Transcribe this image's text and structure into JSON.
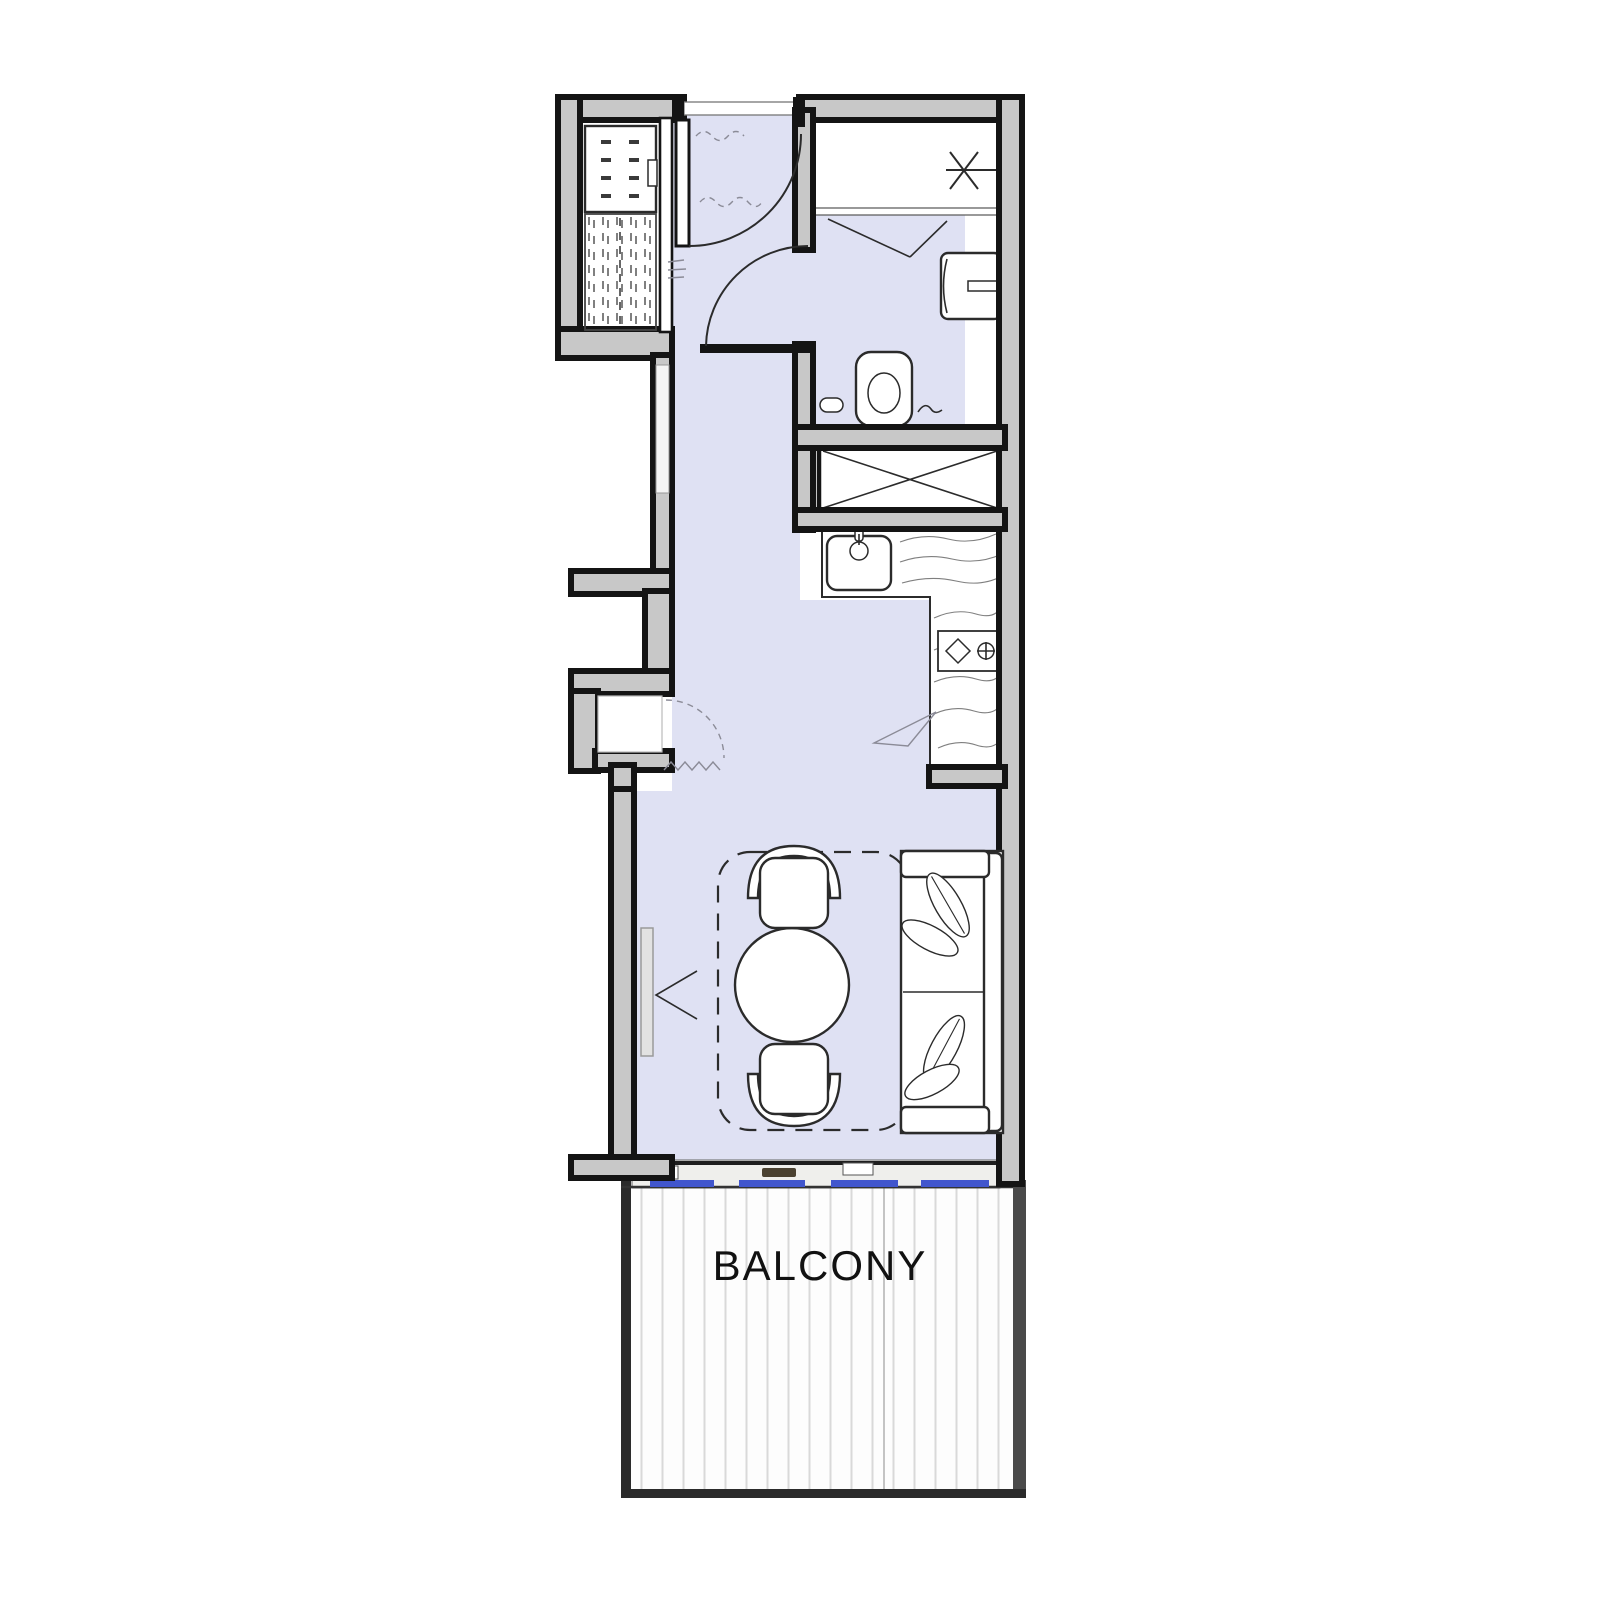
{
  "balcony": {
    "label": "BALCONY"
  },
  "colors": {
    "background": "#ffffff",
    "floor": "#dfe1f3",
    "wall_fill": "#c8c8c8",
    "wall_line": "#141414",
    "fixture_line": "#2b2b2b",
    "sketch_line": "#8b8b97",
    "texture_line": "#5f5f5f",
    "glass_blue": "#4156cd",
    "sill_fill": "#efefec",
    "deck_bg": "#fdfdfd",
    "deck_stripe": "#d9d9d9",
    "balcony_frame": "#2b2b2b",
    "label_text": "#111111"
  }
}
